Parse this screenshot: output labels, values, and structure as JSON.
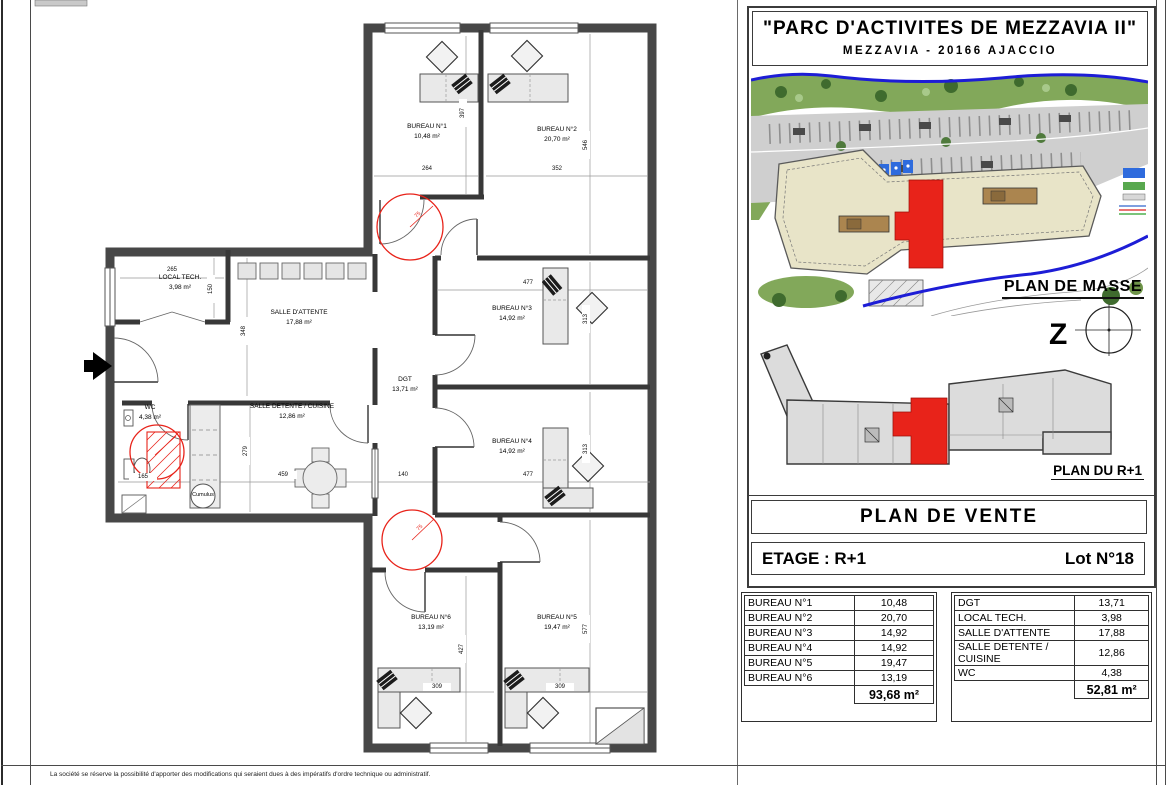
{
  "title_block": {
    "project_title": "\"PARC D'ACTIVITES DE MEZZAVIA II\"",
    "project_address": "MEZZAVIA - 20166 AJACCIO",
    "plan_masse_label": "PLAN DE MASSE",
    "north_symbol": "Z",
    "plan_r1_label": "PLAN DU R+1",
    "document_type": "PLAN DE VENTE",
    "floor_label": "ETAGE : R+1",
    "lot_label": "Lot N°18"
  },
  "surfaces_left": {
    "rows": [
      {
        "label": "BUREAU N°1",
        "value": "10,48"
      },
      {
        "label": "BUREAU N°2",
        "value": "20,70"
      },
      {
        "label": "BUREAU N°3",
        "value": "14,92"
      },
      {
        "label": "BUREAU N°4",
        "value": "14,92"
      },
      {
        "label": "BUREAU N°5",
        "value": "19,47"
      },
      {
        "label": "BUREAU N°6",
        "value": "13,19"
      }
    ],
    "total": "93,68 m²"
  },
  "surfaces_right": {
    "rows": [
      {
        "label": "DGT",
        "value": "13,71"
      },
      {
        "label": "LOCAL TECH.",
        "value": "3,98"
      },
      {
        "label": "SALLE D'ATTENTE",
        "value": "17,88"
      },
      {
        "label": "SALLE DETENTE / CUISINE",
        "value": "12,86"
      },
      {
        "label": "WC",
        "value": "4,38"
      }
    ],
    "total": "52,81 m²"
  },
  "floor_plan": {
    "rooms": [
      {
        "name": "BUREAU N°1",
        "area": "10,48 m²"
      },
      {
        "name": "BUREAU N°2",
        "area": "20,70 m²"
      },
      {
        "name": "LOCAL TECH.",
        "area": "3,98 m²"
      },
      {
        "name": "SALLE D'ATTENTE",
        "area": "17,88 m²"
      },
      {
        "name": "DGT",
        "area": "13,71 m²"
      },
      {
        "name": "BUREAU N°3",
        "area": "14,92 m²"
      },
      {
        "name": "BUREAU N°4",
        "area": "14,92 m²"
      },
      {
        "name": "SALLE DETENTE / CUISINE",
        "area": "12,86 m²"
      },
      {
        "name": "WC",
        "area": "4,38 m²"
      },
      {
        "name": "BUREAU N°5",
        "area": "19,47 m²"
      },
      {
        "name": "BUREAU N°6",
        "area": "13,19 m²"
      }
    ],
    "dims": [
      {
        "t": "264"
      },
      {
        "t": "352"
      },
      {
        "t": "397"
      },
      {
        "t": "546"
      },
      {
        "t": "265"
      },
      {
        "t": "150"
      },
      {
        "t": "348"
      },
      {
        "t": "477"
      },
      {
        "t": "313"
      },
      {
        "t": "459"
      },
      {
        "t": "140"
      },
      {
        "t": "477"
      },
      {
        "t": "313"
      },
      {
        "t": "279"
      },
      {
        "t": "165"
      },
      {
        "t": "427"
      },
      {
        "t": "577"
      },
      {
        "t": "309"
      },
      {
        "t": "309"
      },
      {
        "t": "75"
      },
      {
        "t": "75"
      }
    ],
    "equipment": {
      "cumulus": "Cumulus"
    }
  },
  "sheet": {
    "disclaimer": "La société se réserve la possibilité d'apporter des modifications qui seraient dues à des impératifs d'ordre technique ou administratif."
  },
  "colors": {
    "lot_red": "#e8231a",
    "boundary_blue": "#1d1dd6",
    "wall_gray": "#474747",
    "building_beige": "#e8e4c8"
  }
}
